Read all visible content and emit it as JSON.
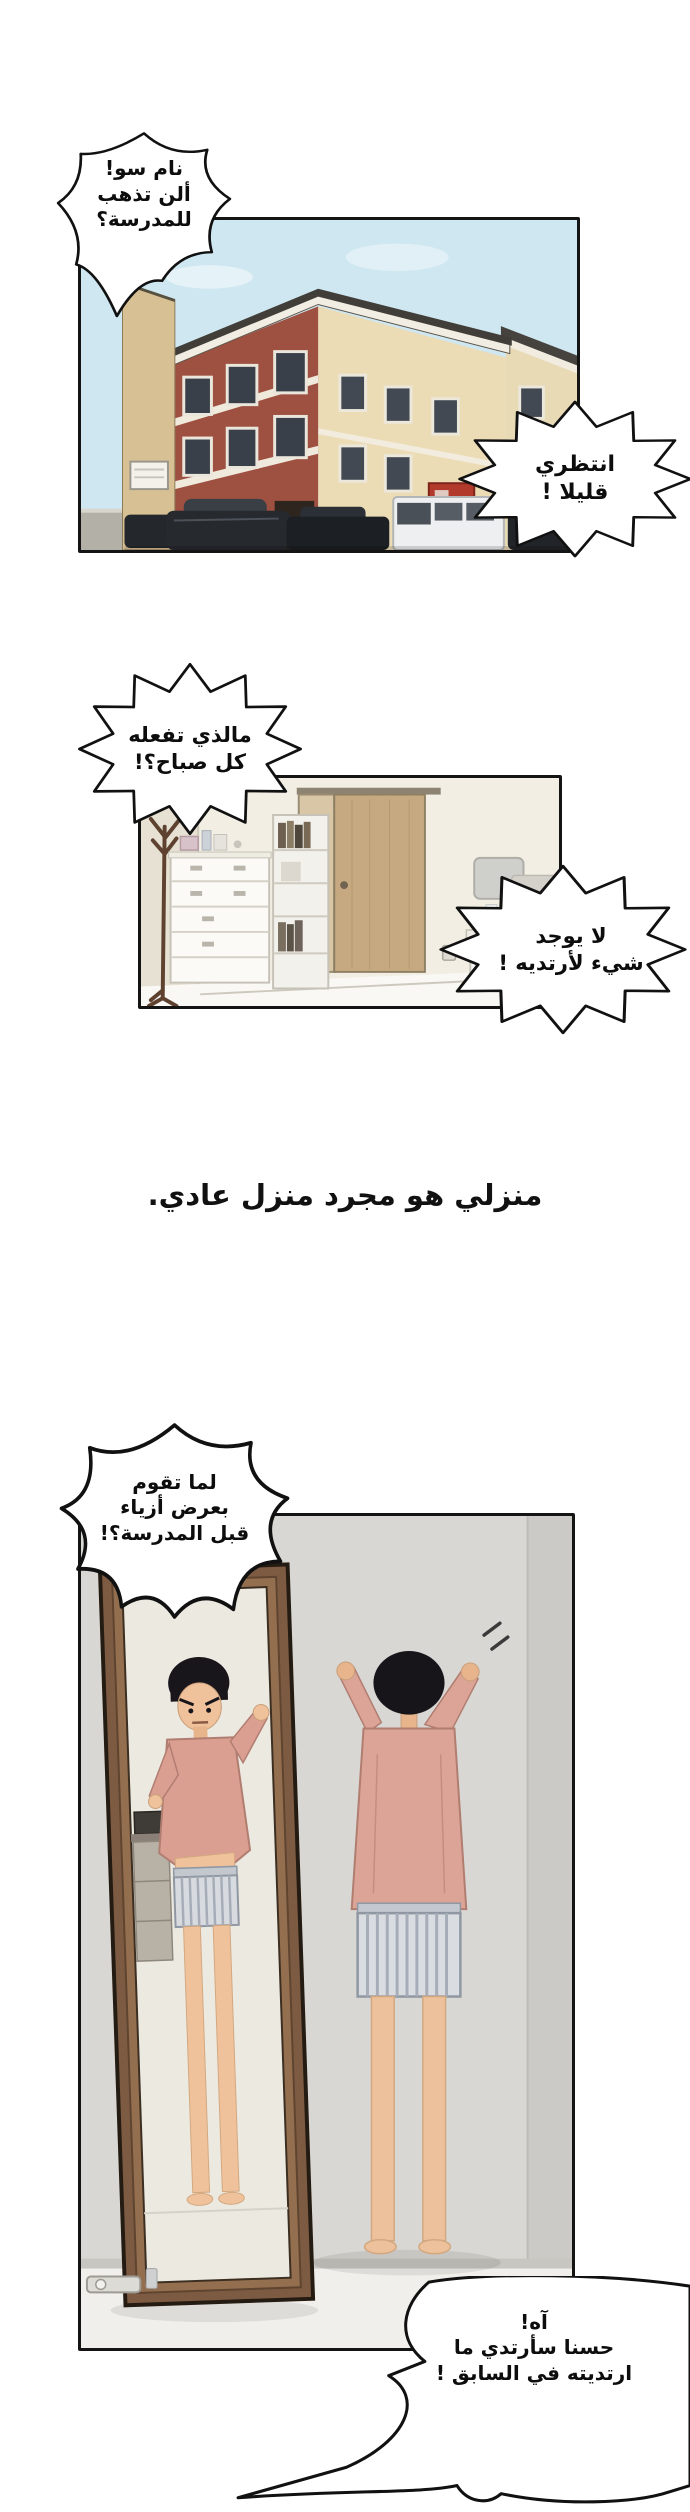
{
  "speech": {
    "bubble1": {
      "lines": [
        "نام سو!",
        "ألن تذهب",
        "للمدرسة؟"
      ]
    },
    "bubble2": {
      "lines": [
        "انتظري",
        "قليلا !"
      ]
    },
    "bubble3": {
      "lines": [
        "مالذي تفعله",
        "كل صباح؟!"
      ]
    },
    "bubble4": {
      "lines": [
        "لا يوجد",
        "شيء لأرتديه !"
      ]
    },
    "bubble5": {
      "lines": [
        "لما تقوم",
        "بعرض أزياء",
        "قبل المدرسة؟!"
      ]
    },
    "bubble6": {
      "lines": [
        "آه!",
        "حسنا سأرتدي ما",
        "ارتديته في السابق !"
      ]
    }
  },
  "narration": {
    "text": "منزلي هو مجرد منزل عادي."
  },
  "colors": {
    "page_background": "#ffffff",
    "panel_border": "#141414",
    "bubble_fill": "#ffffff",
    "bubble_stroke": "#111111",
    "text": "#0d0d0d",
    "sky": "#cfe7f0",
    "brick_wall": "#9e5140",
    "cream_wall": "#ecdcb6",
    "foreground_wall": "#d6c094",
    "room_wall": "#f2eee4",
    "door_wood": "#c6a981",
    "gray_wall": "#d8d7d3",
    "mirror_frame": "#7d5b42",
    "shirt_salmon": "#dba496",
    "skin": "#ecc19c",
    "boxers": "#d9dce0",
    "sign_red": "#b23a2c"
  }
}
